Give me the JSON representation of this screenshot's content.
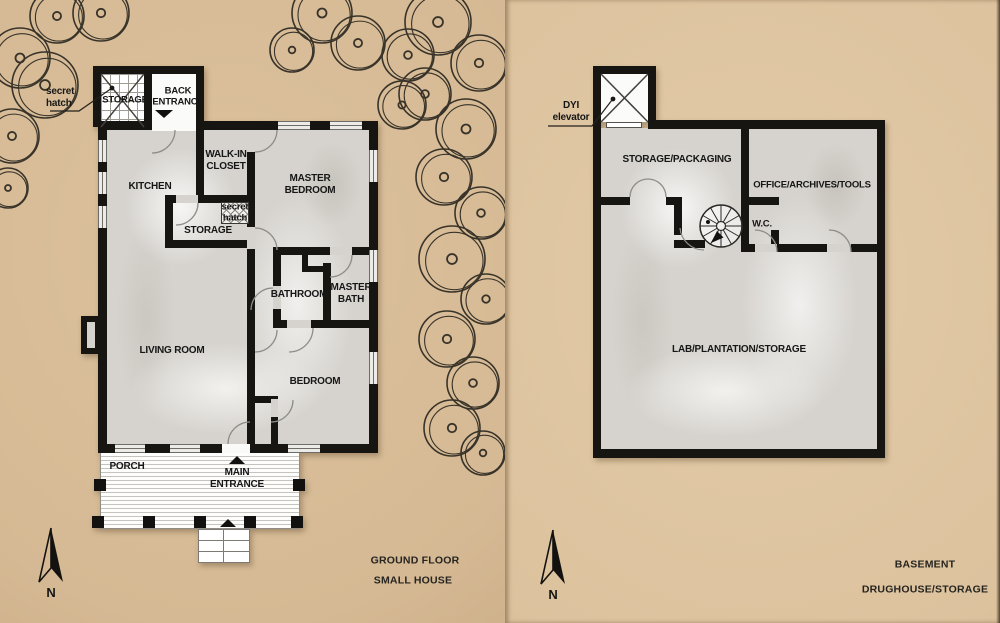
{
  "left_panel": {
    "rooms": {
      "kitchen": "KITCHEN",
      "walk_in_closet": "WALK-IN CLOSET",
      "master_bedroom": "MASTER BEDROOM",
      "storage_annex": "STORAGE",
      "back_entrance": "BACK ENTRANCE",
      "secret_hatch_top": "secret hatch",
      "secret_hatch_mid": "secret hatch",
      "storage_mid": "STORAGE",
      "bathroom": "BATHROOM",
      "master_bath": "MASTER BATH",
      "living_room": "LIVING ROOM",
      "bedroom": "BEDROOM",
      "porch": "PORCH",
      "main_entrance": "MAIN ENTRANCE"
    },
    "caption_line1": "GROUND FLOOR",
    "caption_line2": "SMALL HOUSE",
    "compass": "N"
  },
  "right_panel": {
    "rooms": {
      "elevator": "DYI elevator",
      "storage_packaging": "STORAGE/PACKAGING",
      "office": "OFFICE/ARCHIVES/TOOLS",
      "wc": "W.C.",
      "lab": "LAB/PLANTATION/STORAGE"
    },
    "caption_line1": "BASEMENT",
    "caption_line2": "DRUGHOUSE/STORAGE",
    "compass": "N"
  },
  "colors": {
    "wall": "#171512",
    "floor": "#d6d3ce",
    "background_left": "#d5b994",
    "background_right": "#dcc29d"
  }
}
